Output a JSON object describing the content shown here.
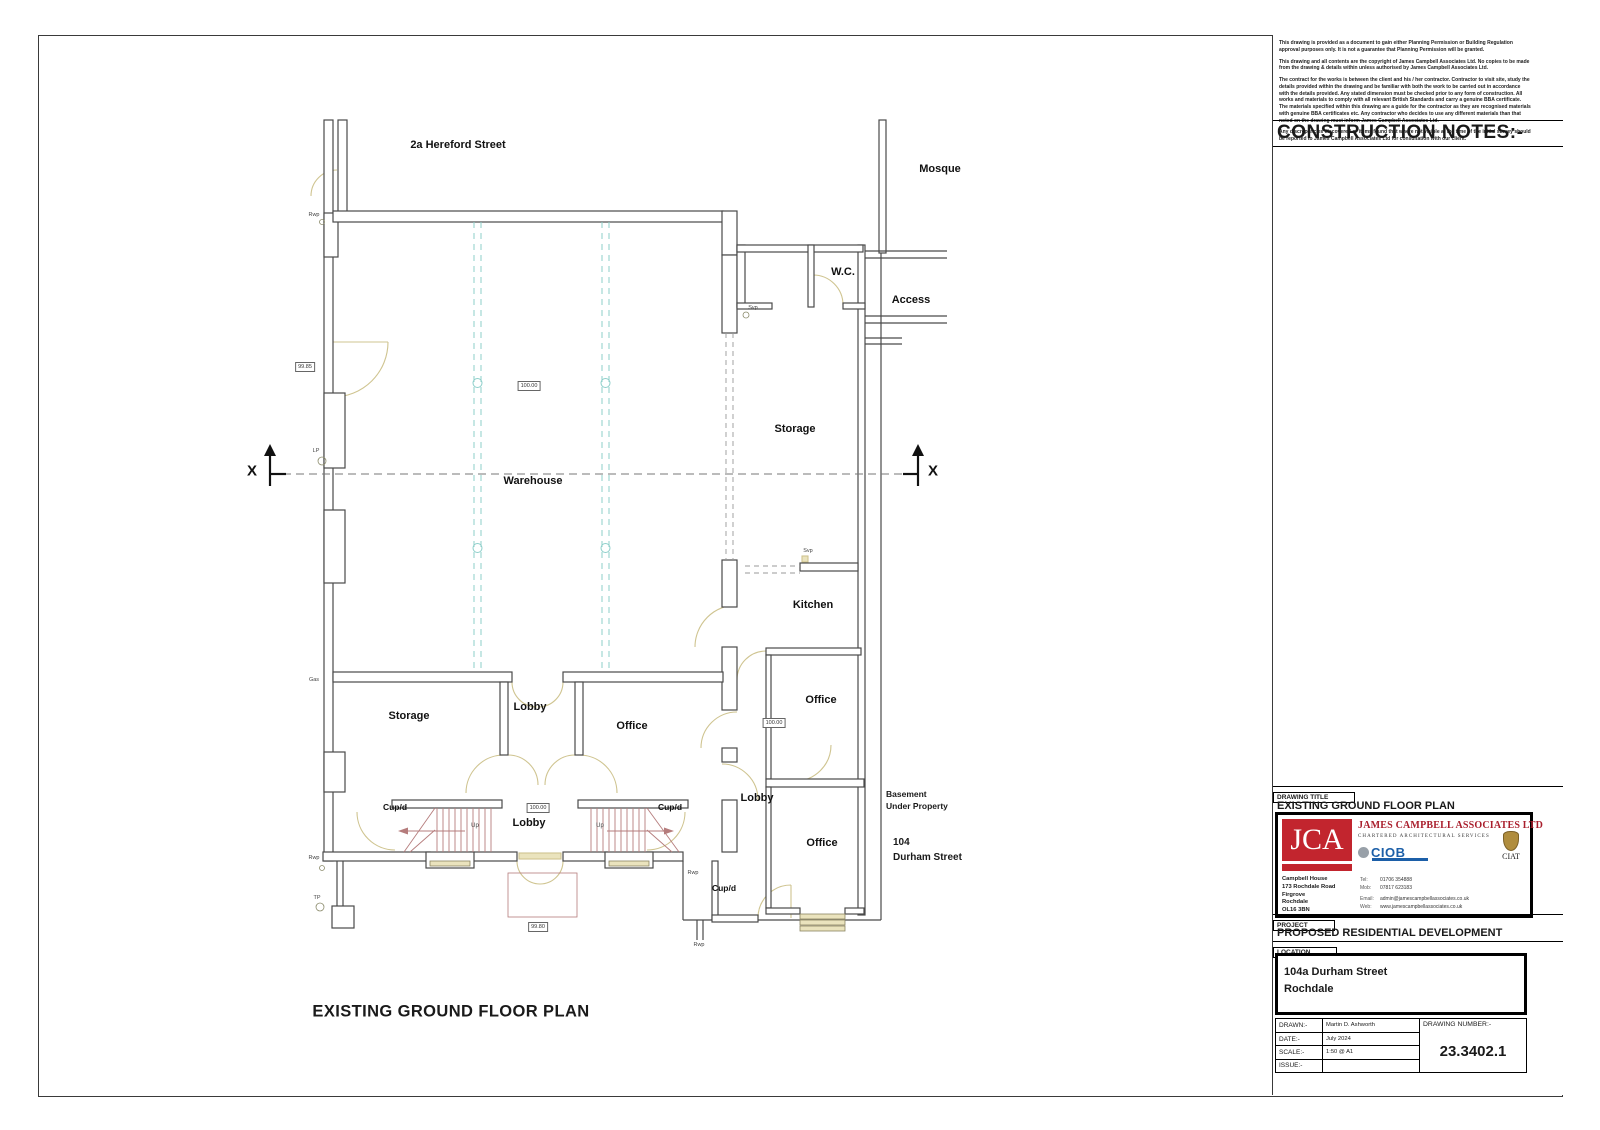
{
  "notes_panel": {
    "heading": "CONSTRUCTION NOTES:-",
    "paragraphs": [
      "This drawing is provided as a document to gain either Planning Permission or Building Regulation approval purposes only. It is not a guarantee that Planning Permission will be granted.",
      "This drawing and all contents are the copyright of James Campbell Associates Ltd. No copies to be made from the drawing & details within unless authorised by James Campbell Associates Ltd.",
      "The contract for the works is between the client and his / her contractor. Contractor to visit site, study the details provided within the drawing and be familiar with both the work to be carried out in accordance with the details provided. Any stated dimension must be checked prior to any form of construction. All works and materials to comply with all relevant British Standards and carry a genuine BBA certificate. The materials specified within this drawing are a guide for the contractor as they are recognised materials with genuine BBA certificates etc. Any contractor who decides to use any different materials than that noted on the drawing must inform James Campbell Associates Ltd.",
      "Any discrepancies discovered or items found that where not visible at the time of the initial survey should be reported to James Campbell Associates Ltd for consultation with our client."
    ]
  },
  "plan": {
    "street_label": "2a Hereford Street",
    "mosque": "Mosque",
    "wc": "W.C.",
    "access": "Access",
    "storage_right": "Storage",
    "warehouse": "Warehouse",
    "kitchen": "Kitchen",
    "office_mid": "Office",
    "lobby_right": "Lobby",
    "office_bottom_right": "Office",
    "storage_bottom": "Storage",
    "lobby_center": "Lobby",
    "office_bottom": "Office",
    "lobby_entrance": "Lobby",
    "cupd": "Cup/d",
    "up": "Up",
    "section_marker": "X",
    "levels": {
      "left_wall": "99.85",
      "warehouse": "100.00",
      "office": "100.00",
      "entrance_hall": "100.00",
      "outside": "99.80"
    },
    "tags": {
      "rwp": "Rwp",
      "svp": "Svp",
      "lp": "LP",
      "tp": "TP",
      "gas": "Gas"
    },
    "basement_lines": [
      "Basement",
      "Under Property"
    ],
    "neighbour_lines": [
      "104",
      "Durham Street"
    ],
    "caption": "EXISTING GROUND FLOOR PLAN"
  },
  "title_block": {
    "drawing_title_label": "DRAWING TITLE",
    "drawing_title": "EXISTING GROUND FLOOR PLAN",
    "company": {
      "initials": "JCA",
      "name": "JAMES CAMPBELL ASSOCIATES LTD",
      "tagline": "CHARTERED ARCHITECTURAL SERVICES",
      "ciob_label": "CIOB",
      "ciat_label": "CIAT",
      "address_lines": [
        "Campbell House",
        "173 Rochdale Road",
        "Firgrove",
        "Rochdale",
        "OL16 3BN"
      ],
      "tel_label": "Tel:",
      "tel": "01706 354888",
      "mob_label": "Mob:",
      "mob": "07817 623183",
      "email_label": "Email:",
      "email": "admin@jamescampbellassociates.co.uk",
      "web_label": "Web:",
      "web": "www.jamescampbellassociates.co.uk"
    },
    "project_label": "PROJECT",
    "project": "PROPOSED RESIDENTIAL DEVELOPMENT",
    "location_label": "LOCATION",
    "location_lines": [
      "104a Durham Street",
      "Rochdale"
    ],
    "fields": [
      {
        "label": "DRAWN:-",
        "value": "Martin D. Ashworth"
      },
      {
        "label": "DATE:-",
        "value": "July 2024"
      },
      {
        "label": "SCALE:-",
        "value": "1:50  @ A1"
      },
      {
        "label": "ISSUE:-",
        "value": ""
      }
    ],
    "drawing_number_label": "DRAWING NUMBER:-",
    "drawing_number": "23.3402.1"
  },
  "colors": {
    "brand_red": "#a91e2c",
    "ciob_blue": "#1c5fa8",
    "wall": "#4a4a4a",
    "joinery_cream": "#eae3bd",
    "column_teal": "#8ecfca",
    "stair_red": "#b57c7c"
  }
}
